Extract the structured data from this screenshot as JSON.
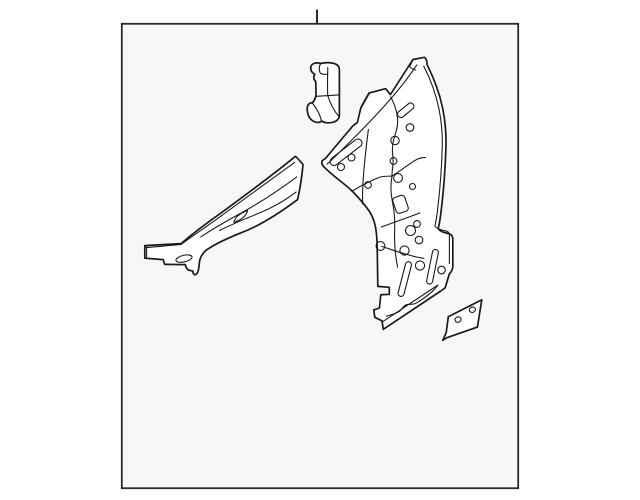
{
  "colors": {
    "page_bg": "#ffffff",
    "canvas_bg": "#f7f7f7",
    "line": "#1a1a1a",
    "frame": "#2b2b2b",
    "part_fill": "#ffffff"
  },
  "diagram": {
    "kind": "monochrome-line-art-parts-illustration",
    "callout_tick": "top-center",
    "parts": [
      {
        "name": "small-bracket",
        "position": "top-center"
      },
      {
        "name": "pillar-panel-with-holes",
        "position": "right"
      },
      {
        "name": "tapered-rail",
        "position": "lower-left"
      },
      {
        "name": "small-plate",
        "position": "lower-right"
      }
    ]
  }
}
